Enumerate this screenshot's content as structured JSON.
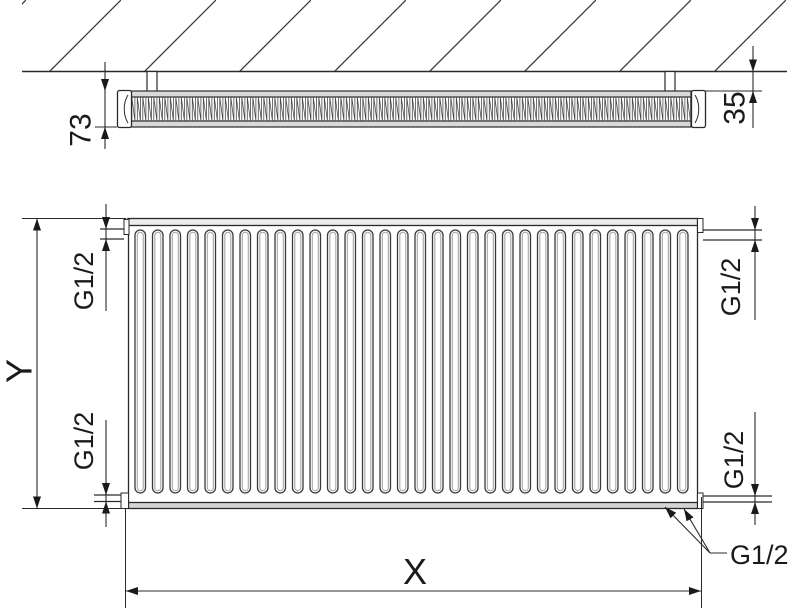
{
  "drawing": {
    "top_view": {
      "depth_label": "73",
      "wall_clearance_label": "35"
    },
    "front_view": {
      "height_label": "Y",
      "width_label": "X",
      "channel_count": 32
    },
    "connections": {
      "top_left": "G1/2",
      "top_right": "G1/2",
      "bottom_left": "G1/2",
      "bottom_right": "G1/2",
      "bottom_outlet": "G1/2"
    },
    "style": {
      "line_color": "#2a2a2a",
      "band_fill": "#d9d9d9",
      "groove_shade": "#a8a8a8",
      "background": "#ffffff"
    }
  }
}
